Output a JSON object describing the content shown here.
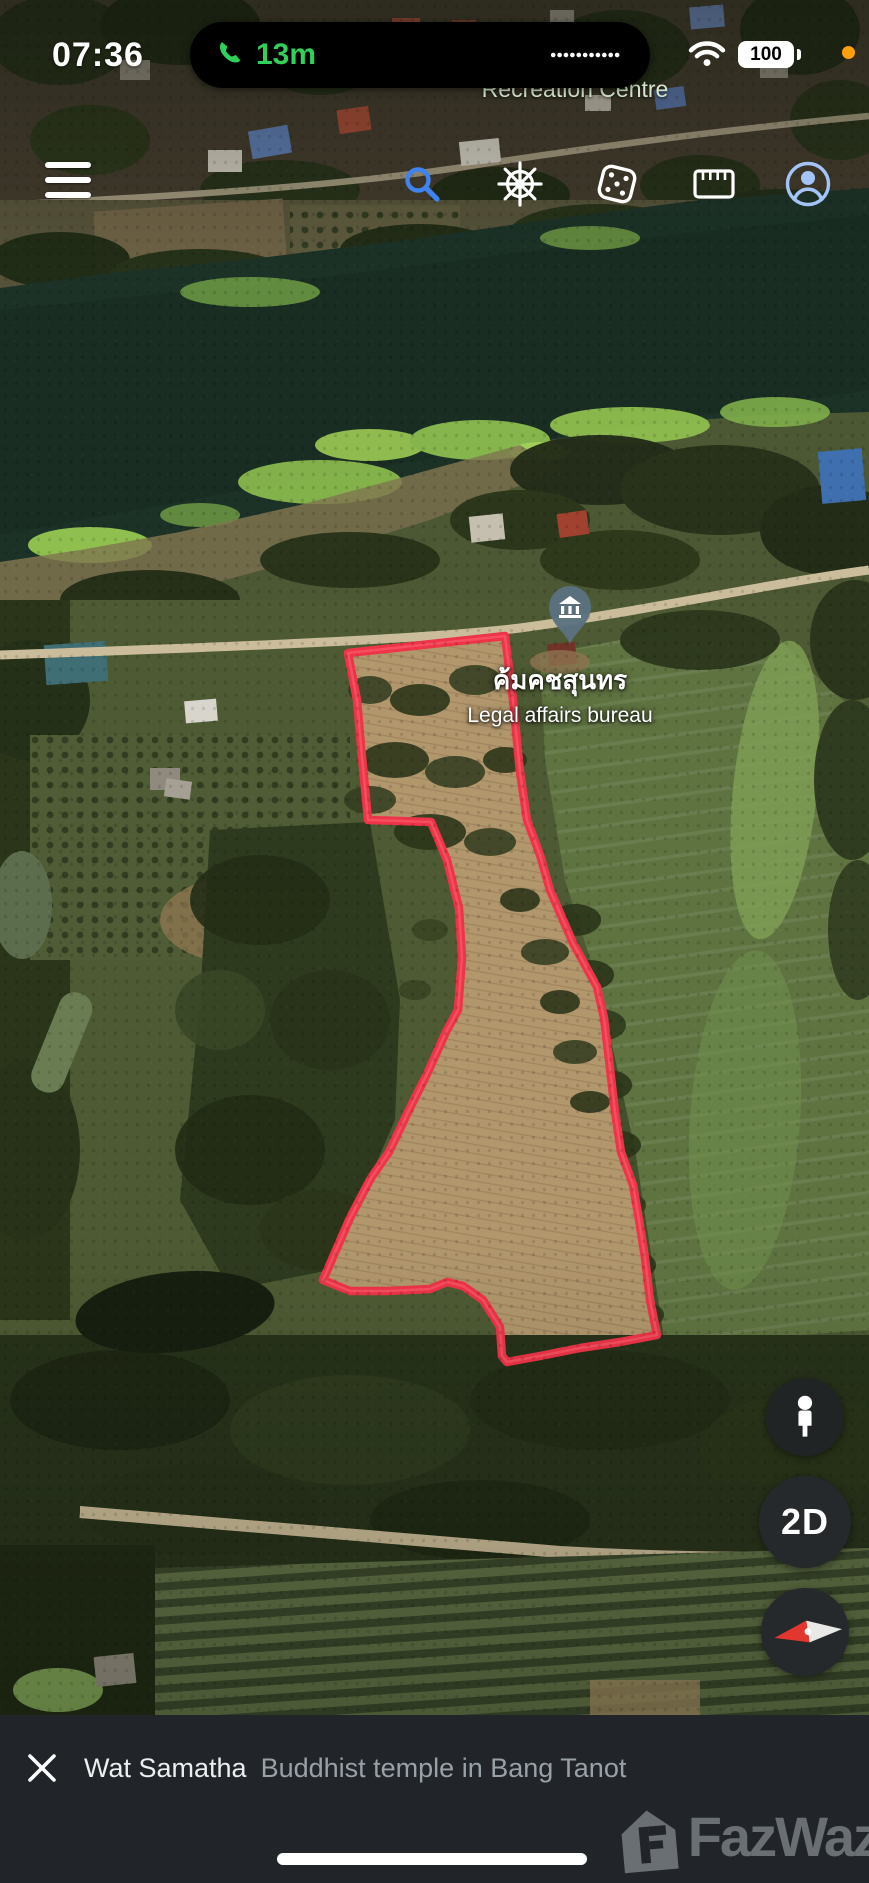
{
  "colors": {
    "plot_outline": "#ee3448",
    "plot_outline_highlight": "#ff6573",
    "call_green": "#30d158",
    "search_blue": "#4083ef",
    "profile_blue": "#a4c4f7",
    "mic_indicator": "#ff9f0a"
  },
  "status_bar": {
    "time": "07:36",
    "call_duration": "13m",
    "battery_level": "100"
  },
  "toolbar": {
    "icons": [
      "menu-icon",
      "search-icon",
      "voyager-wheel-icon",
      "feeling-lucky-dice-icon",
      "measure-icon",
      "account-icon"
    ]
  },
  "map": {
    "labels": {
      "partially_hidden_poi": "Recreation Centre"
    },
    "poi": {
      "title_thai": "ค้มคชสุนทร",
      "subtitle_en": "Legal affairs bureau"
    }
  },
  "map_controls": {
    "view_mode_label": "2D",
    "icons": [
      "pegman-icon",
      "compass-icon"
    ]
  },
  "bottom_bar": {
    "title": "Wat Samatha",
    "subtitle": "Buddhist temple in Bang Tanot"
  },
  "watermark": {
    "brand": "FazWaz"
  }
}
